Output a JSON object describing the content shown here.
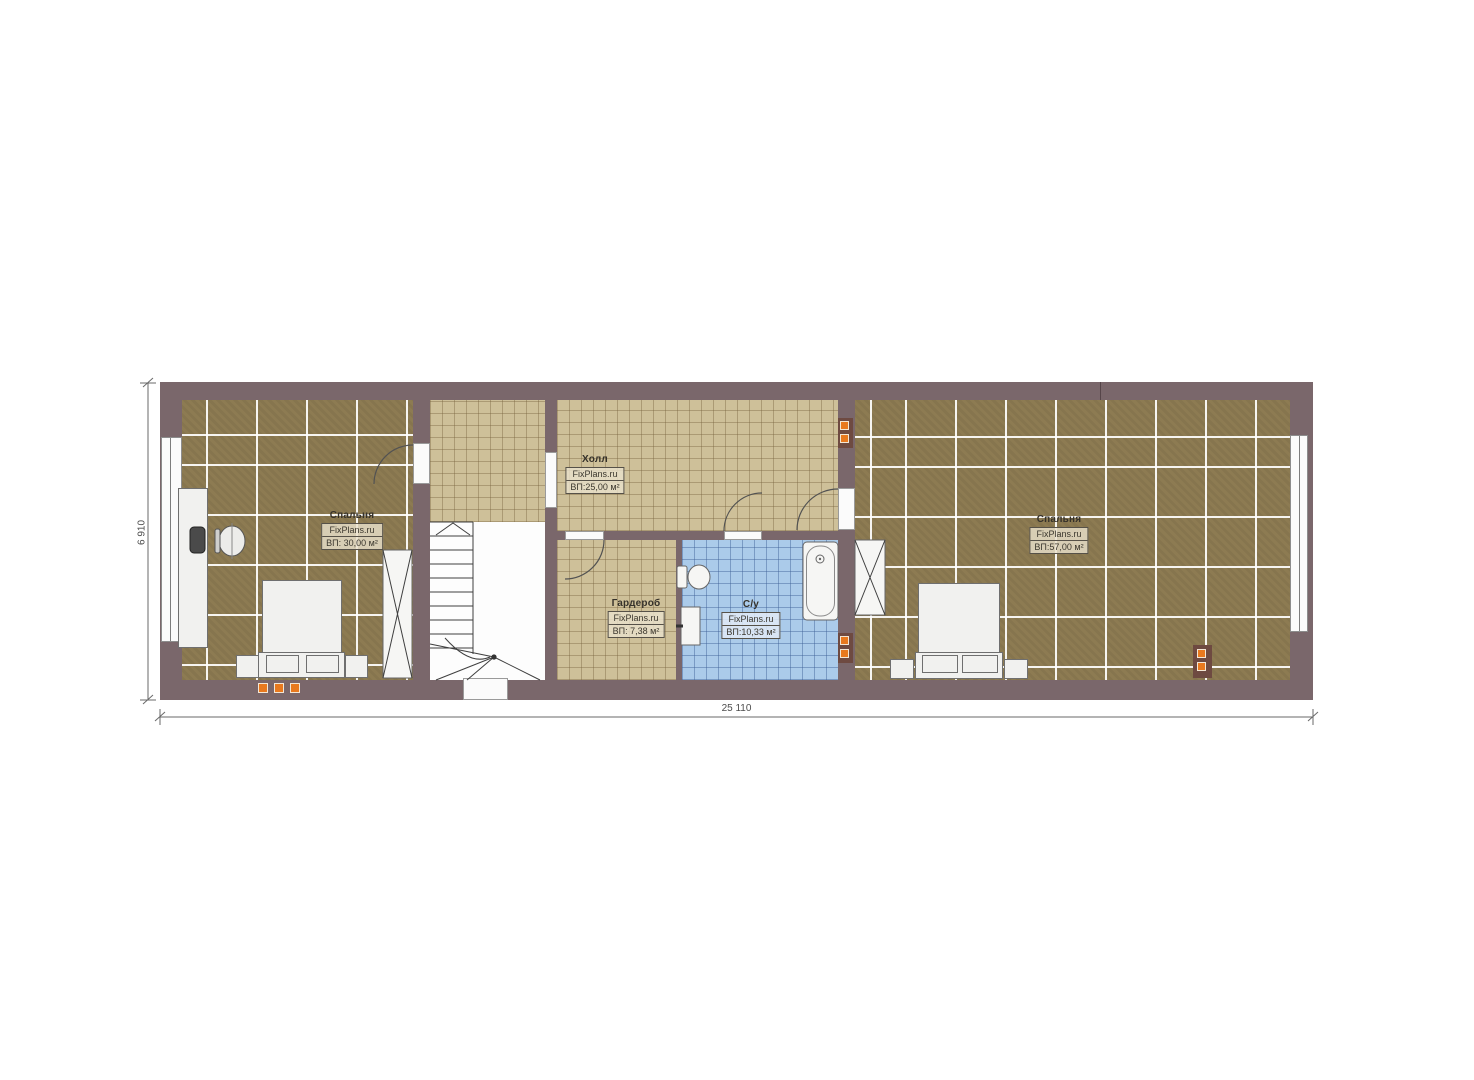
{
  "plan": {
    "rooms": [
      {
        "name": "Спальня",
        "source": "FixPlans.ru",
        "area": "ВП: 30,00 м²"
      },
      {
        "name": "Холл",
        "source": "FixPlans.ru",
        "area": "ВП:25,00 м²"
      },
      {
        "name": "Гардероб",
        "source": "FixPlans.ru",
        "area": "ВП: 7,38 м²"
      },
      {
        "name": "С/у",
        "source": "FixPlans.ru",
        "area": "ВП:10,33 м²"
      },
      {
        "name": "Спальня",
        "source": "FixPlans.ru",
        "area": "ВП:57,00 м²"
      }
    ],
    "dimensions": {
      "width": "25 110",
      "height": "6 910"
    },
    "colors": {
      "wall": "#7a676b",
      "bedroom_floor": "#8d7b52",
      "hall_floor": "#cec099",
      "bath_floor": "#abcbea",
      "marker": "#e8791e",
      "panel": "#6e4a41"
    }
  }
}
